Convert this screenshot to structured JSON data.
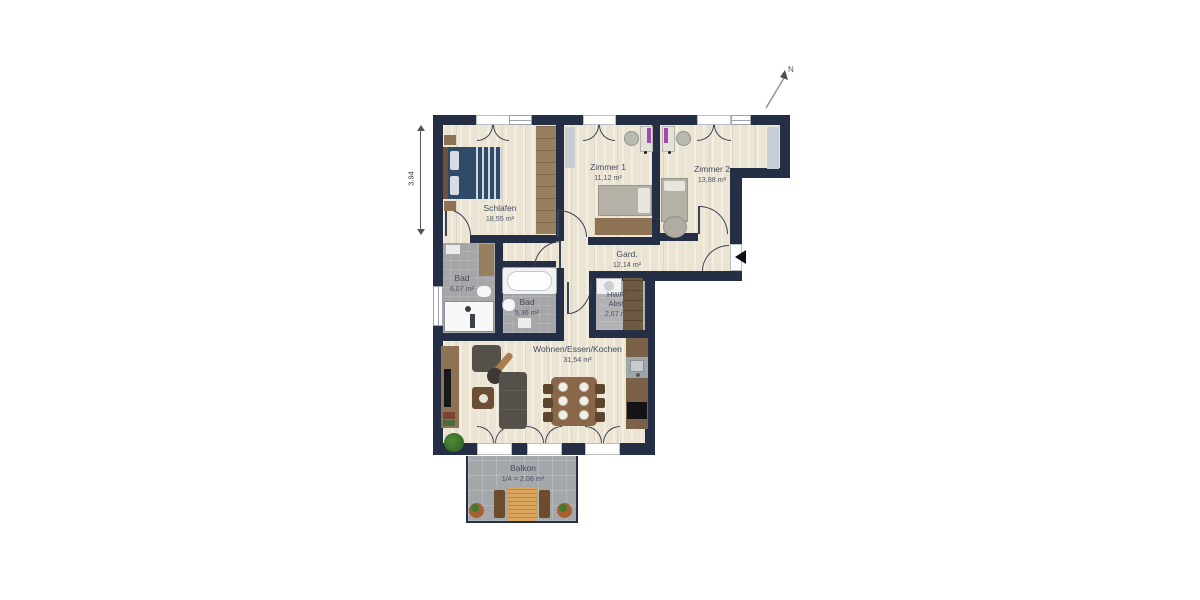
{
  "rooms": {
    "schlafen": {
      "name": "Schlafen",
      "area": "18,55 m²"
    },
    "zimmer1": {
      "name": "Zimmer 1",
      "area": "11,12 m²"
    },
    "zimmer2": {
      "name": "Zimmer 2",
      "area": "13,88 m²"
    },
    "gard": {
      "name": "Gard.",
      "area": "12,14 m²"
    },
    "bad_gross": {
      "name": "Bad",
      "area": "6,07 m²"
    },
    "bad_klein": {
      "name": "Bad",
      "area": "5,36 m²"
    },
    "hwr": {
      "name_line1": "HWR/",
      "name_line2": "Abst.",
      "area": "2,67 m²"
    },
    "wohnen": {
      "name": "Wohnen/Essen/Kochen",
      "area": "31,54 m²"
    },
    "balkon": {
      "name": "Balkon",
      "area": "1/4 = 2,06 m²"
    }
  },
  "dimension": {
    "value": "3.94"
  },
  "compass": {
    "label": "N"
  },
  "colors": {
    "wall": "#242e45",
    "wood_floor": "#ece4d3",
    "tile_floor": "#a6a6a9",
    "balcony_floor": "#a4a8ab",
    "furniture_wood": "#97805e",
    "bed_navy": "#2f4b68"
  }
}
